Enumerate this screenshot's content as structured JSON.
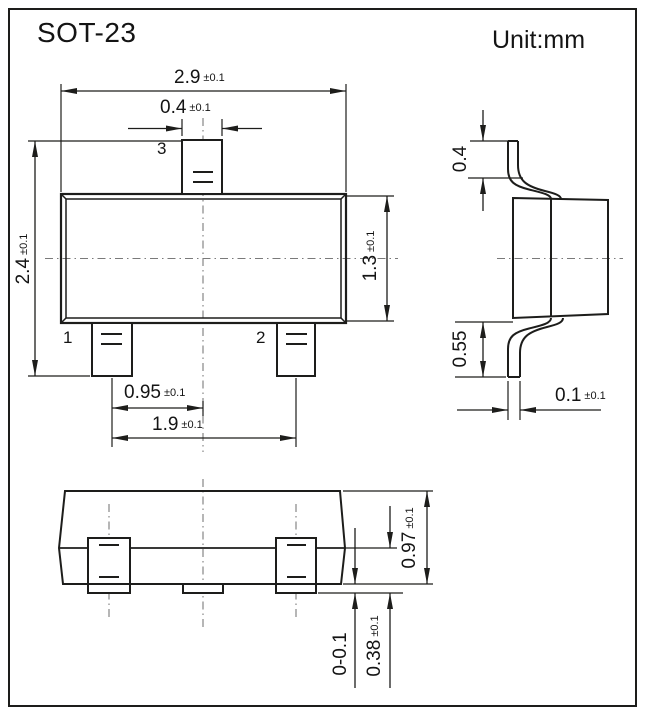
{
  "header": {
    "title": "SOT-23",
    "unit": "Unit:mm"
  },
  "top_view": {
    "pin1_label": "1",
    "pin2_label": "2",
    "pin3_label": "3",
    "dims": {
      "body_width": {
        "value": "2.9",
        "tol": "±0.1"
      },
      "pin_width": {
        "value": "0.4",
        "tol": "±0.1"
      },
      "overall_height": {
        "value": "2.4",
        "tol": "±0.1"
      },
      "body_depth": {
        "value": "1.3",
        "tol": "±0.1"
      },
      "pin_pitch": {
        "value": "0.95",
        "tol": "±0.1"
      },
      "pin_span": {
        "value": "1.9",
        "tol": "±0.1"
      }
    }
  },
  "side_view": {
    "dims": {
      "lead_top_length": {
        "value": "0.4",
        "tol": ""
      },
      "lead_bottom_length": {
        "value": "0.55",
        "tol": ""
      },
      "lead_thickness": {
        "value": "0.1",
        "tol": "±0.1"
      }
    }
  },
  "front_view": {
    "dims": {
      "body_height": {
        "value": "0.97",
        "tol": "±0.1"
      },
      "standoff": {
        "value": "0-0.1",
        "tol": ""
      },
      "lead_shoulder": {
        "value": "0.38",
        "tol": "±0.1"
      }
    }
  },
  "colors": {
    "line": "#1d1d1b",
    "centerline": "#7a7a7a",
    "background": "#ffffff"
  }
}
